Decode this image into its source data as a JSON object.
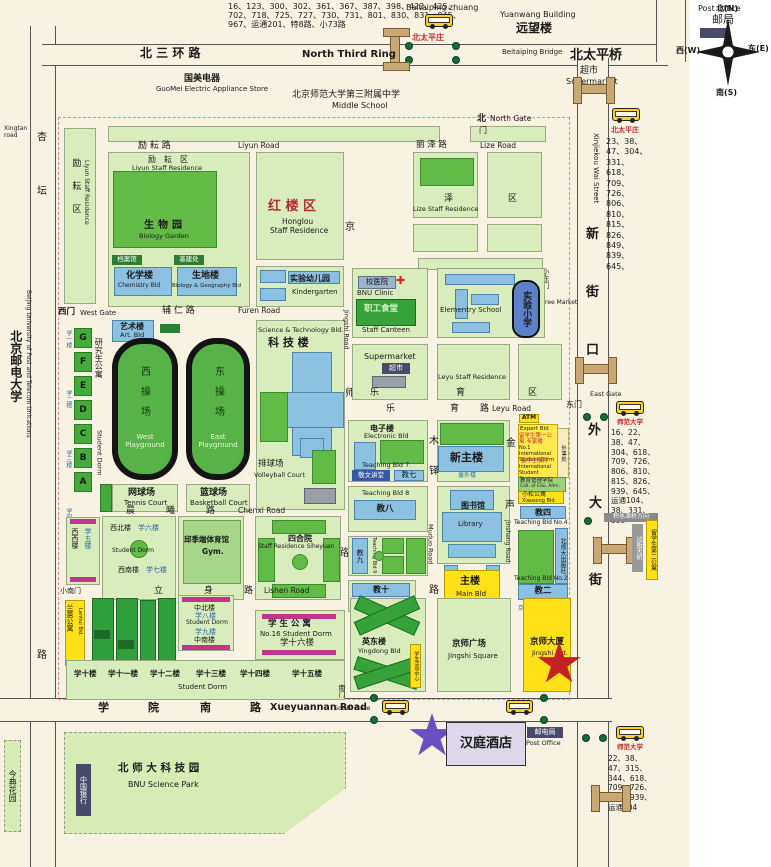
{
  "compass": {
    "n": "北(N)",
    "w": "西(W)",
    "e": "东(E)",
    "s": "南(S)"
  },
  "roads": {
    "north_third_ring": {
      "zh": "北  三  环  路",
      "en": "North Third Ring"
    },
    "beitaiping_bridge": {
      "zh": "北太平桥",
      "en": "Beitaiping Bridge"
    },
    "xinjiekou": {
      "en": "Xinjiekou Wai Street",
      "c1": "新",
      "c2": "街",
      "c3": "口",
      "c4": "外",
      "c5": "大",
      "c6": "街"
    },
    "xingtan": {
      "en": "Xingtan road",
      "c1": "杏",
      "c2": "坛",
      "c3": "路"
    },
    "xueyuannan": {
      "en": "Xueyuannan Road",
      "c1": "学",
      "c2": "院",
      "c3": "南",
      "c4": "路"
    },
    "liyun": {
      "zh": "励  耘  路",
      "en": "Liyun Road"
    },
    "lize": {
      "zh": "丽  泽  路",
      "en": "Lize Road"
    },
    "furen": {
      "zh": "辅  仁  路",
      "en": "Furen Road"
    },
    "leyu": {
      "c1": "乐",
      "c2": "育",
      "c3": "路",
      "en": "Leyu Road"
    },
    "jingshi": {
      "en": "Jingshi Road",
      "c1": "京",
      "c2": "师",
      "c3": "路"
    },
    "muduo": {
      "en": "Muduo Road",
      "c1": "木",
      "c2": "铎",
      "c3": "路"
    },
    "jinsheng": {
      "en": "Jinsheng Road",
      "c1": "金",
      "c2": "声"
    },
    "chenxi": {
      "c1": "晨",
      "c2": "曦",
      "c3": "路",
      "en": "Chenxi Road"
    },
    "lishen": {
      "c1": "立",
      "c2": "身",
      "c3": "路",
      "en": "Lishen Road"
    }
  },
  "gates": {
    "north": {
      "zh": "北",
      "door": "门",
      "en": "North Gate"
    },
    "west": {
      "zh": "西门",
      "en": "West Gate"
    },
    "east": {
      "zh": "东门",
      "en": "East Gate"
    },
    "south": {
      "zh": "南门",
      "en": "South Gate"
    },
    "small_east": {
      "zh": "小东门"
    },
    "small_south": {
      "zh": "小南门"
    },
    "free_market": {
      "en": "Free Market"
    }
  },
  "bus_stops": {
    "north": {
      "en": "Beitaiping zhuang",
      "zh": "北太平庄",
      "routes": "16、123、300、302、361、367、387、398、422、425、702、718、725、727、730、731、801、830、831、845、967、运通201、特8路、小73路"
    },
    "northeast": {
      "zh": "北太平庄",
      "routes": "23、38、47、304、331、618、709、726、806、810、815、826、849、839、645、"
    },
    "east": {
      "zh": "师范大学",
      "routes": "16、22、38、47、304、618、709、726、806、810、815、826、939、645、运通104、38、331、398",
      "direction": "积水潭桥方向"
    },
    "south": {
      "zh": "师范大学",
      "routes": "22、38、47、315、344、618、709、726、826、939、运通104"
    }
  },
  "offcampus": {
    "guomei": {
      "zh": "国美电器",
      "en": "GuoMei Electric Appliance Store"
    },
    "middle_school": {
      "zh": "北京师范大学第三附属中学",
      "en": "Middle School"
    },
    "yuanwang": {
      "zh": "远望楼",
      "en": "Yuanwang Building"
    },
    "post_office_north": {
      "zh": "邮局",
      "en": "Post Office"
    },
    "supermarket_north": {
      "zh": "超市",
      "en": "Supermarket"
    },
    "bupt": {
      "zh": "北京邮电大学",
      "en": "Beijing University of Post and Telecom Unications"
    },
    "jindian": {
      "zh": "今典花园"
    },
    "science_park": {
      "zh": "北 师 大 科 技 园",
      "en": "BNU Science Park"
    },
    "bank_of_china": {
      "zh": "中国银行"
    },
    "hanting_hotel": {
      "zh": "汉庭酒店"
    },
    "post_office_south": {
      "zh": "邮电局",
      "en": "Post Office"
    },
    "footbridge_note": {
      "zh": "过街天桥"
    },
    "dorm2_note": {
      "zh": "留学生第二公寓"
    }
  },
  "campus": {
    "liyun_residence": {
      "zh": "励耘区",
      "en": "Liyun Staff Residence"
    },
    "biology_garden": {
      "zh": "生物园",
      "en": "Biology Garden"
    },
    "archives": {
      "zh": "档案馆"
    },
    "capital_constr": {
      "zh": "基建处"
    },
    "chemistry": {
      "zh": "化学楼",
      "en": "Chemistry Bld"
    },
    "bio_geo": {
      "zh": "生地楼",
      "en": "Biology & Geography Bld"
    },
    "honglou": {
      "zh": "红 楼 区",
      "en1": "Honglou",
      "en2": "Staff Residence"
    },
    "kindergarten": {
      "zh": "实验幼儿园",
      "en": "Kindergarten"
    },
    "lize_residence": {
      "zh1": "泽",
      "zh2": "区",
      "en": "Lize  Staff Residence"
    },
    "art_bld": {
      "zh": "艺术楼",
      "en": "Art. Bld"
    },
    "grad_dorm": {
      "zh": "研究生公寓",
      "en": "Student Dorm",
      "blocks": [
        "G",
        "F",
        "E",
        "D",
        "C",
        "B",
        "A"
      ],
      "side": [
        "学一楼",
        "学二楼",
        "学三楼",
        "学四楼"
      ]
    },
    "west_playground": {
      "zh": "西操场",
      "en": "West Playground"
    },
    "east_playground": {
      "zh": "东操场",
      "en": "East Playground"
    },
    "tennis": {
      "zh": "网球场",
      "en": "Tennis Court"
    },
    "basketball": {
      "zh": "篮球场",
      "en": "Basketball Court"
    },
    "sci_tech": {
      "zh": "科 技 楼",
      "en": "Science & Technology Bld."
    },
    "volleyball": {
      "zh": "排球场",
      "en": "Volleyball Court"
    },
    "clinic": {
      "zh": "校医院",
      "en": "BNU Clinic"
    },
    "staff_canteen": {
      "zh": "职工食堂",
      "en": "Staff Canteen"
    },
    "elementary": {
      "en": "Elementry School"
    },
    "shiyan_primary": {
      "zh": "实验小学"
    },
    "supermarket": {
      "zh": "超市",
      "en": "Supermarket"
    },
    "leyu_residence": {
      "en": "Leyu Staff Residence",
      "c1": "乐",
      "c2": "育",
      "c3": "区"
    },
    "electronic": {
      "zh": "电子楼",
      "en": "Electronic Bld"
    },
    "teaching7": {
      "en": "Teaching Bld 7",
      "hall": "敬文讲堂",
      "zh": "教七"
    },
    "new_main": {
      "zh": "新主楼",
      "note": "援外楼"
    },
    "atm": "ATM",
    "expert": {
      "en": "Expert Bld",
      "zh": "留学生第一公寓·专家楼",
      "en2": "No.1 International Student Dorm",
      "zh2": "留学生餐厅",
      "en3": "International Student Canteen"
    },
    "edu_college": {
      "zh": "教育管理学院",
      "en": "Coll. of Edu. Adm."
    },
    "xiaosong": {
      "zh": "小松公寓",
      "en": "Xiaosong Bld."
    },
    "foreign_affairs": {
      "zh": "外事处"
    },
    "teaching4": {
      "zh": "教四",
      "en": "Teaching Bld No.4"
    },
    "bnu_press": {
      "zh": "北师大出版社",
      "en": "Bnu Press"
    },
    "teaching2": {
      "zh": "教二",
      "en": "Teaching Bld No.2"
    },
    "jingshi_east_gate_note": {
      "zh": "京师大厦东门"
    },
    "teaching8": {
      "zh": "教八",
      "en": "Teaching Bld 8"
    },
    "teaching9": {
      "zh": "教九",
      "en": "Teaching Bld 9"
    },
    "teaching10": {
      "zh": "教十",
      "en": "Teaching Bld 10"
    },
    "library": {
      "zh": "图书馆",
      "en": "Library"
    },
    "main_bld": {
      "zh": "主楼",
      "en": "Main Bld"
    },
    "dorm67": {
      "nw": "西北楼",
      "x6": "学六楼",
      "label": "Student Dorm",
      "sw": "西南楼",
      "x7": "学七楼"
    },
    "xuewu": {
      "a": "西西楼",
      "b": "学五楼"
    },
    "gym": {
      "zh": "邱季端体育馆",
      "en": "Gym."
    },
    "siheyuan": {
      "zh": "四合院",
      "en": "Staff Residence Siheyuan"
    },
    "zhongbei": {
      "a": "中北楼",
      "b": "学八楼",
      "c": "Student Dorm",
      "d": "学九楼",
      "e": "中南楼"
    },
    "dorm16": {
      "zh": "学 生 公 寓",
      "en": "No.16 Student Dorm",
      "zh2": "学十六楼"
    },
    "south_dorms": {
      "l1": "学十楼",
      "l2": "学十一楼",
      "l3": "学十二楼",
      "l4": "学十三楼",
      "l5": "学十四楼",
      "l6": "学十五楼",
      "en": "Student Dorm"
    },
    "lanhui": {
      "zh": "兰蕙公寓",
      "en": "Lanhui Bld."
    },
    "yingdong": {
      "zh": "英东楼",
      "en": "Yingdong Bld",
      "note": "学生活动中心"
    },
    "jingshi_square": {
      "zh": "京师广场",
      "en": "Jingshi Square"
    },
    "jingshi_bld": {
      "zh": "京师大厦",
      "en": "Jingshi Bld."
    }
  }
}
